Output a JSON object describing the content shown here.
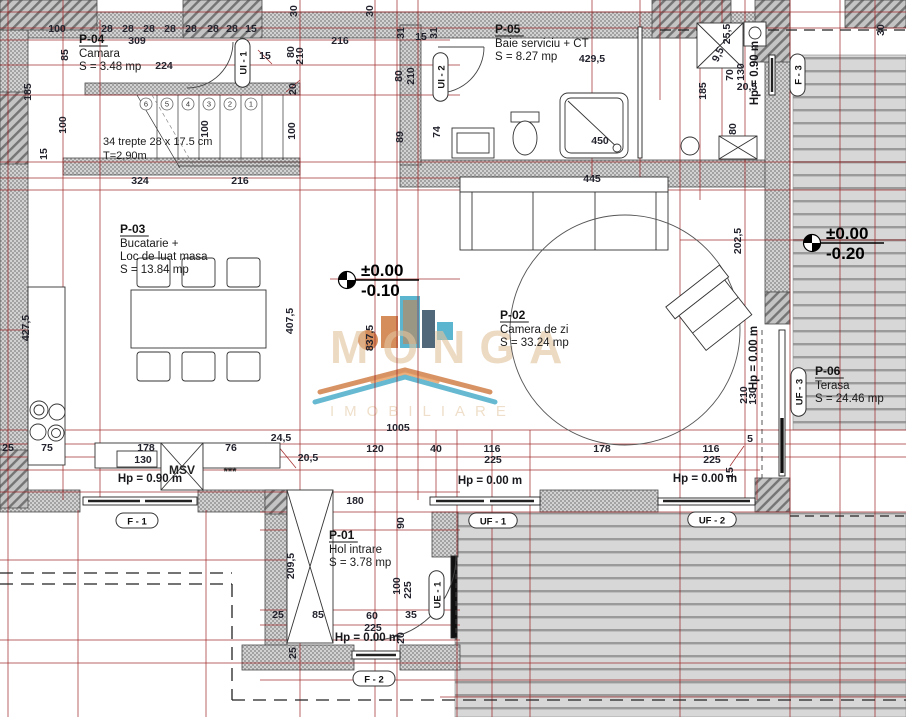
{
  "watermark": {
    "line1": "MONGA",
    "line2": "IMOBILIARE"
  },
  "rooms": [
    {
      "id": "P-04",
      "lines": [
        "Camara",
        "S = 3.48 mp"
      ],
      "x": 79,
      "y": 43
    },
    {
      "id": "P-05",
      "lines": [
        "Baie serviciu + CT",
        "S = 8.27 mp"
      ],
      "x": 495,
      "y": 33
    },
    {
      "id": "P-03",
      "lines": [
        "Bucatarie +",
        "Loc de luat masa",
        "S = 13.84 mp"
      ],
      "x": 120,
      "y": 233
    },
    {
      "id": "P-02",
      "lines": [
        "Camera de zi",
        "S = 33.24 mp"
      ],
      "x": 500,
      "y": 319
    },
    {
      "id": "P-01",
      "lines": [
        "Hol intrare",
        "S = 3.78 mp"
      ],
      "x": 329,
      "y": 539
    },
    {
      "id": "P-06",
      "lines": [
        "Terasa",
        "S = 24.46 mp"
      ],
      "x": 815,
      "y": 375
    }
  ],
  "stairs_note": [
    "34 trepte 28 x 17.5 cm",
    "T=2,90m"
  ],
  "step_numbers": [
    "6",
    "5",
    "4",
    "3",
    "2",
    "1"
  ],
  "labels": {
    "msv": "MSV",
    "stars": "***"
  },
  "levels": [
    {
      "above": "±0.00",
      "below": "-0.10",
      "x": 347,
      "y": 280
    },
    {
      "above": "±0.00",
      "below": "-0.20",
      "x": 812,
      "y": 243
    }
  ],
  "height_markers": [
    {
      "t": "Hp = 0.90 m",
      "x": 150,
      "y": 482,
      "r": 0
    },
    {
      "t": "Hp = 0.90 m",
      "x": 758,
      "y": 73,
      "r": -90
    },
    {
      "t": "Hp = 0.00 m",
      "x": 367,
      "y": 641,
      "r": 0
    },
    {
      "t": "Hp = 0.00 m",
      "x": 490,
      "y": 484,
      "r": 0
    },
    {
      "t": "Hp = 0.00 m",
      "x": 705,
      "y": 482,
      "r": 0
    },
    {
      "t": "Hp = 0.00 m",
      "x": 757,
      "y": 358,
      "r": -90
    }
  ],
  "openings": [
    {
      "t": "F - 1",
      "x": 137,
      "y": 521,
      "r": 0
    },
    {
      "t": "F - 2",
      "x": 374,
      "y": 679,
      "r": 0
    },
    {
      "t": "F - 3",
      "x": 798,
      "y": 75,
      "r": -90
    },
    {
      "t": "UF - 1",
      "x": 493,
      "y": 521,
      "r": 0
    },
    {
      "t": "UF - 2",
      "x": 712,
      "y": 520,
      "r": 0
    },
    {
      "t": "UF - 3",
      "x": 799,
      "y": 392,
      "r": -90
    },
    {
      "t": "UE - 1",
      "x": 437,
      "y": 595,
      "r": -90
    },
    {
      "t": "UI - 1",
      "x": 243,
      "y": 63,
      "r": -90
    },
    {
      "t": "UI - 2",
      "x": 441,
      "y": 77,
      "r": -90
    }
  ],
  "dimensions": [
    {
      "t": "100",
      "x": 57,
      "y": 32
    },
    {
      "t": "28",
      "x": 107,
      "y": 32
    },
    {
      "t": "28",
      "x": 128,
      "y": 32
    },
    {
      "t": "28",
      "x": 149,
      "y": 32
    },
    {
      "t": "28",
      "x": 170,
      "y": 32
    },
    {
      "t": "28",
      "x": 191,
      "y": 32
    },
    {
      "t": "28",
      "x": 213,
      "y": 32
    },
    {
      "t": "28",
      "x": 232,
      "y": 32
    },
    {
      "t": "15",
      "x": 251,
      "y": 32
    },
    {
      "t": "309",
      "x": 137,
      "y": 44
    },
    {
      "t": "85",
      "x": 68,
      "y": 55,
      "r": -90
    },
    {
      "t": "224",
      "x": 164,
      "y": 69
    },
    {
      "t": "185",
      "x": 31,
      "y": 92,
      "r": -90
    },
    {
      "t": "100",
      "x": 66,
      "y": 125,
      "r": -90
    },
    {
      "t": "100",
      "x": 208,
      "y": 129,
      "r": -90
    },
    {
      "t": "100",
      "x": 295,
      "y": 131,
      "r": -90
    },
    {
      "t": "15",
      "x": 47,
      "y": 154,
      "r": -90
    },
    {
      "t": "15",
      "x": 265,
      "y": 59
    },
    {
      "t": "324",
      "x": 140,
      "y": 184
    },
    {
      "t": "216",
      "x": 240,
      "y": 184
    },
    {
      "t": "216",
      "x": 340,
      "y": 44
    },
    {
      "t": "30",
      "x": 297,
      "y": 11,
      "r": -90
    },
    {
      "t": "30",
      "x": 373,
      "y": 11,
      "r": -90
    },
    {
      "t": "30",
      "x": 884,
      "y": 30,
      "r": -90
    },
    {
      "t": "80",
      "x": 294,
      "y": 52,
      "r": -90
    },
    {
      "t": "210",
      "x": 303,
      "y": 56,
      "r": -90
    },
    {
      "t": "20",
      "x": 296,
      "y": 89,
      "r": -90
    },
    {
      "t": "31",
      "x": 404,
      "y": 33,
      "r": -90
    },
    {
      "t": "15",
      "x": 421,
      "y": 40
    },
    {
      "t": "31",
      "x": 437,
      "y": 33,
      "r": -90
    },
    {
      "t": "80",
      "x": 402,
      "y": 76,
      "r": -90
    },
    {
      "t": "210",
      "x": 414,
      "y": 76,
      "r": -90
    },
    {
      "t": "89",
      "x": 403,
      "y": 137,
      "r": -90
    },
    {
      "t": "74",
      "x": 440,
      "y": 132,
      "r": -90
    },
    {
      "t": "429,5",
      "x": 592,
      "y": 62
    },
    {
      "t": "450",
      "x": 600,
      "y": 144
    },
    {
      "t": "185",
      "x": 706,
      "y": 91,
      "r": -90
    },
    {
      "t": "25,5",
      "x": 730,
      "y": 34,
      "r": -90
    },
    {
      "t": "9,5",
      "x": 721,
      "y": 56,
      "r": -65
    },
    {
      "t": "70",
      "x": 733,
      "y": 75,
      "r": -90
    },
    {
      "t": "130",
      "x": 744,
      "y": 72,
      "r": -90
    },
    {
      "t": "20,5",
      "x": 747,
      "y": 90
    },
    {
      "t": "80",
      "x": 736,
      "y": 129,
      "r": -90
    },
    {
      "t": "445",
      "x": 592,
      "y": 182
    },
    {
      "t": "202,5",
      "x": 741,
      "y": 241,
      "r": -90
    },
    {
      "t": "837,5",
      "x": 373,
      "y": 338,
      "r": -90
    },
    {
      "t": "407,5",
      "x": 293,
      "y": 321,
      "r": -90
    },
    {
      "t": "427,5",
      "x": 29,
      "y": 328,
      "r": -90
    },
    {
      "t": "1005",
      "x": 398,
      "y": 431
    },
    {
      "t": "210",
      "x": 747,
      "y": 395,
      "r": -90
    },
    {
      "t": "130",
      "x": 756,
      "y": 396,
      "r": -90
    },
    {
      "t": "5",
      "x": 750,
      "y": 442
    },
    {
      "t": "25",
      "x": 8,
      "y": 451
    },
    {
      "t": "75",
      "x": 47,
      "y": 451
    },
    {
      "t": "178",
      "x": 146,
      "y": 451
    },
    {
      "t": "130",
      "x": 143,
      "y": 463
    },
    {
      "t": "76",
      "x": 231,
      "y": 451
    },
    {
      "t": "24,5",
      "x": 281,
      "y": 441
    },
    {
      "t": "20,5",
      "x": 308,
      "y": 461
    },
    {
      "t": "120",
      "x": 375,
      "y": 452
    },
    {
      "t": "40",
      "x": 436,
      "y": 452
    },
    {
      "t": "116",
      "x": 492,
      "y": 452
    },
    {
      "t": "225",
      "x": 493,
      "y": 463
    },
    {
      "t": "178",
      "x": 602,
      "y": 452
    },
    {
      "t": "116",
      "x": 711,
      "y": 452
    },
    {
      "t": "225",
      "x": 712,
      "y": 463
    },
    {
      "t": "15",
      "x": 733,
      "y": 473,
      "r": -90
    },
    {
      "t": "180",
      "x": 355,
      "y": 504
    },
    {
      "t": "90",
      "x": 404,
      "y": 523,
      "r": -90
    },
    {
      "t": "209,5",
      "x": 294,
      "y": 566,
      "r": -90
    },
    {
      "t": "100",
      "x": 400,
      "y": 586,
      "r": -90
    },
    {
      "t": "225",
      "x": 411,
      "y": 590,
      "r": -90
    },
    {
      "t": "25",
      "x": 278,
      "y": 618
    },
    {
      "t": "85",
      "x": 318,
      "y": 618
    },
    {
      "t": "60",
      "x": 372,
      "y": 619
    },
    {
      "t": "225",
      "x": 373,
      "y": 631
    },
    {
      "t": "35",
      "x": 411,
      "y": 618
    },
    {
      "t": "20",
      "x": 404,
      "y": 638,
      "r": -90
    },
    {
      "t": "25",
      "x": 296,
      "y": 653,
      "r": -90
    }
  ],
  "colors": {
    "dim_line_red": "#9b1b1b",
    "wall_gray": "#cfcfcf",
    "deck_gray": "#d7d7d7",
    "logo_orange": "#c96a2a",
    "logo_teal": "#2b9fc0",
    "logo_navy": "#1c3a52"
  }
}
